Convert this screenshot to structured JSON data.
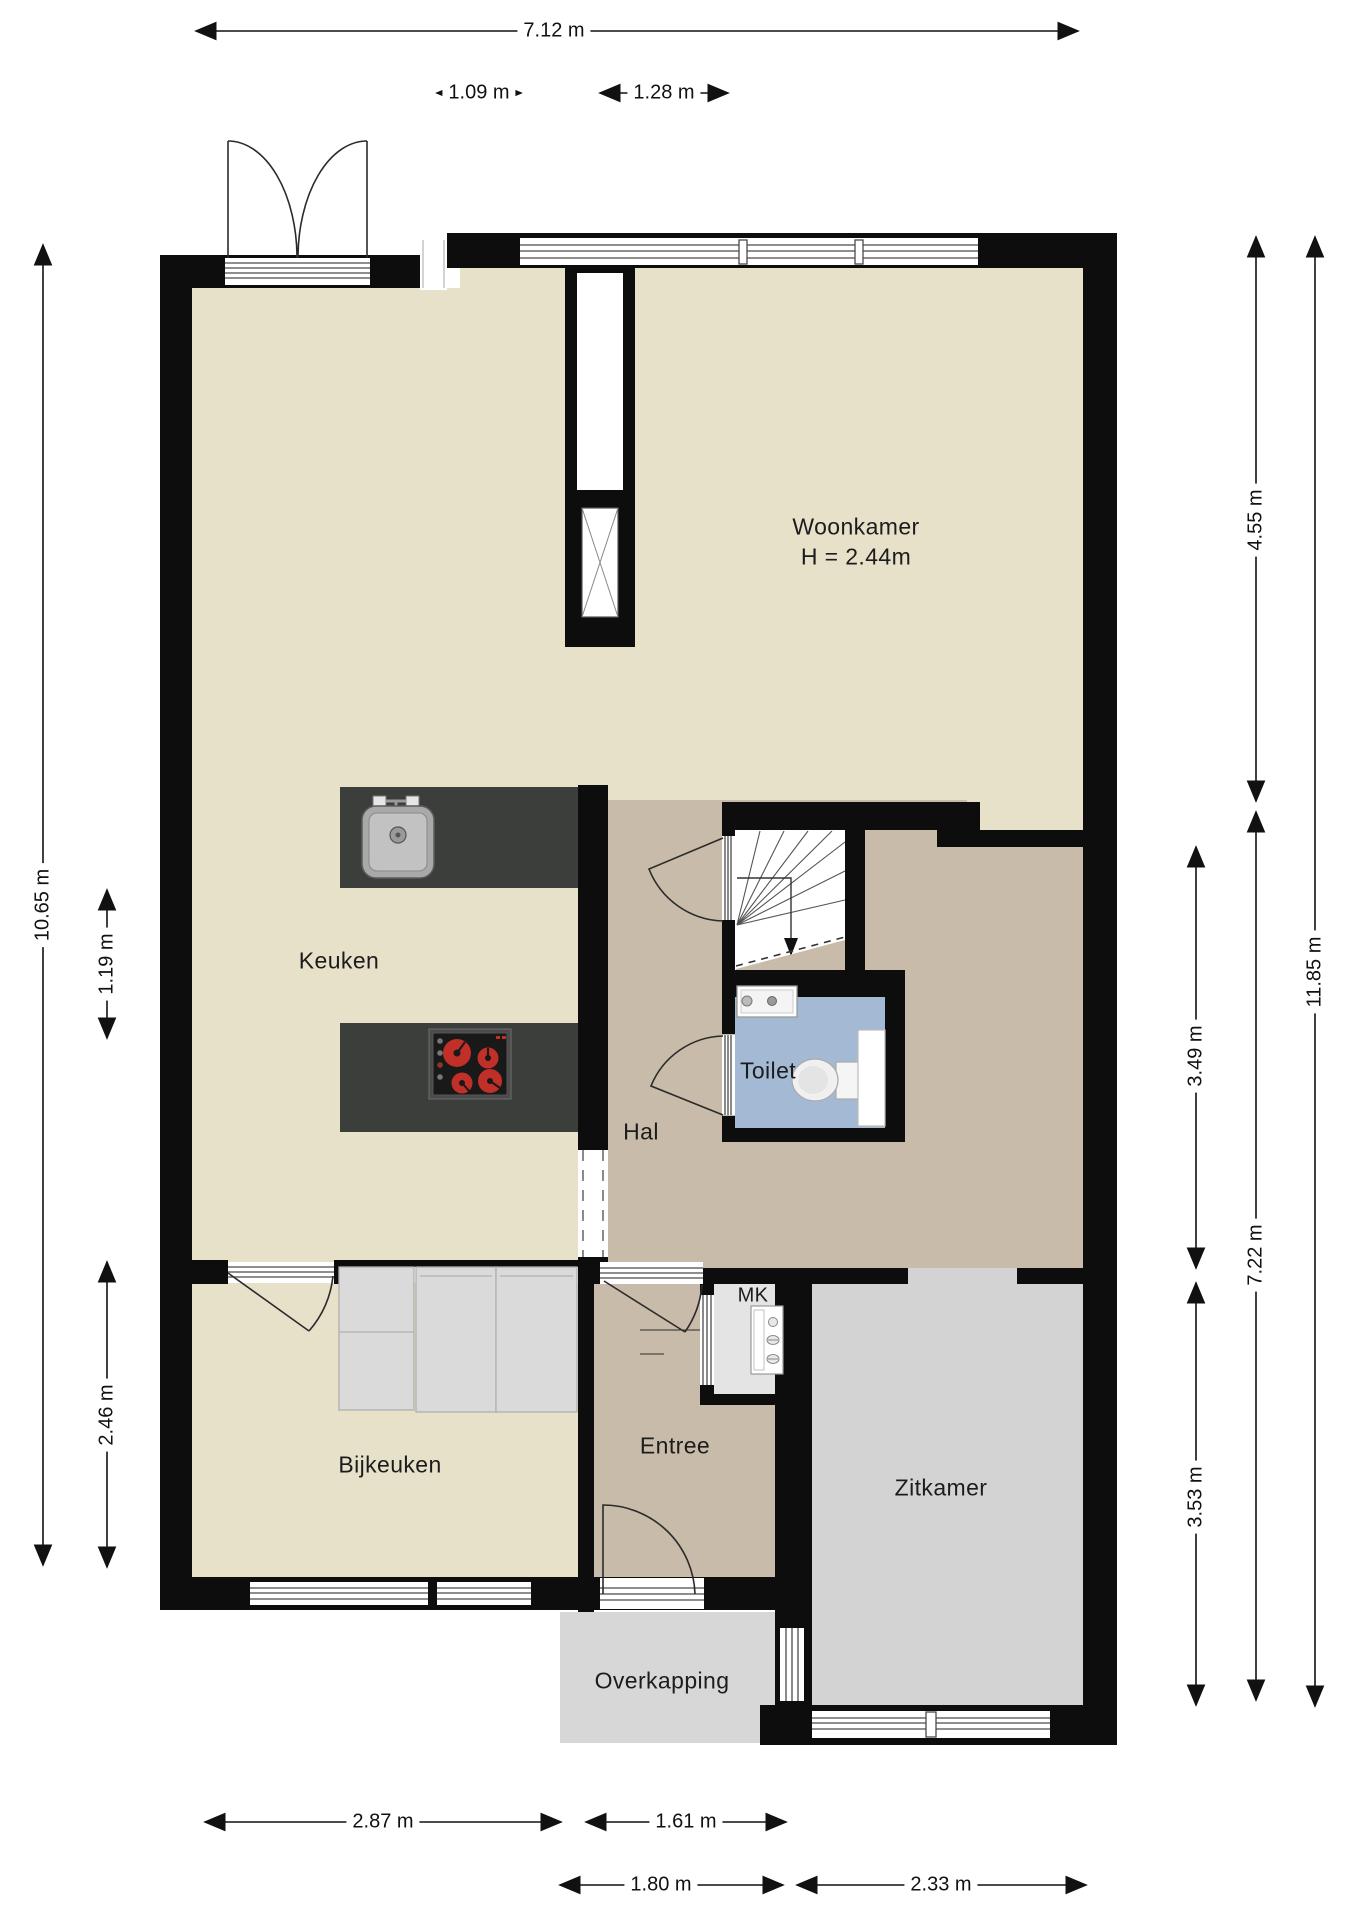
{
  "plan_title": "Begane grond plattegrond",
  "colors": {
    "wall": "#0d0d0d",
    "beige": "#e8e1ca",
    "taupe": "#c9bbaa",
    "blue": "#a4bad4",
    "gray": "#d3d3d3",
    "ovk": "#d7d7d7",
    "mk": "#e4e4e4",
    "counter": "#3c3e3c",
    "burner_red": "#c03028"
  },
  "rooms": [
    {
      "label": "Woonkamer",
      "sublabel": "H = 2.44m"
    },
    {
      "label": "Keuken"
    },
    {
      "label": "Hal"
    },
    {
      "label": "Toilet"
    },
    {
      "label": "MK"
    },
    {
      "label": "Bijkeuken"
    },
    {
      "label": "Entree"
    },
    {
      "label": "Zitkamer"
    },
    {
      "label": "Overkapping"
    }
  ],
  "dimensions": {
    "top": [
      {
        "label": "7.12 m"
      },
      {
        "label": "1.09 m"
      },
      {
        "label": "1.28 m"
      }
    ],
    "left": [
      {
        "label": "10.65 m"
      },
      {
        "label": "1.19 m"
      },
      {
        "label": "2.46 m"
      }
    ],
    "right": [
      {
        "label": "4.55 m"
      },
      {
        "label": "7.22 m"
      },
      {
        "label": "11.85 m"
      },
      {
        "label": "3.49 m"
      },
      {
        "label": "3.53 m"
      }
    ],
    "bottom": [
      {
        "label": "2.87 m"
      },
      {
        "label": "1.61 m"
      },
      {
        "label": "1.80 m"
      },
      {
        "label": "2.33 m"
      }
    ]
  },
  "icons": {
    "kitchen_sink": "sink-icon",
    "cooktop": "cooktop-icon",
    "washbasin": "washbasin-icon",
    "toilet_bowl": "toilet-bowl-icon",
    "meter_cabinet": "meter-cabinet-icon",
    "staircase": "staircase-icon",
    "stair_direction": "arrow-down-icon"
  }
}
